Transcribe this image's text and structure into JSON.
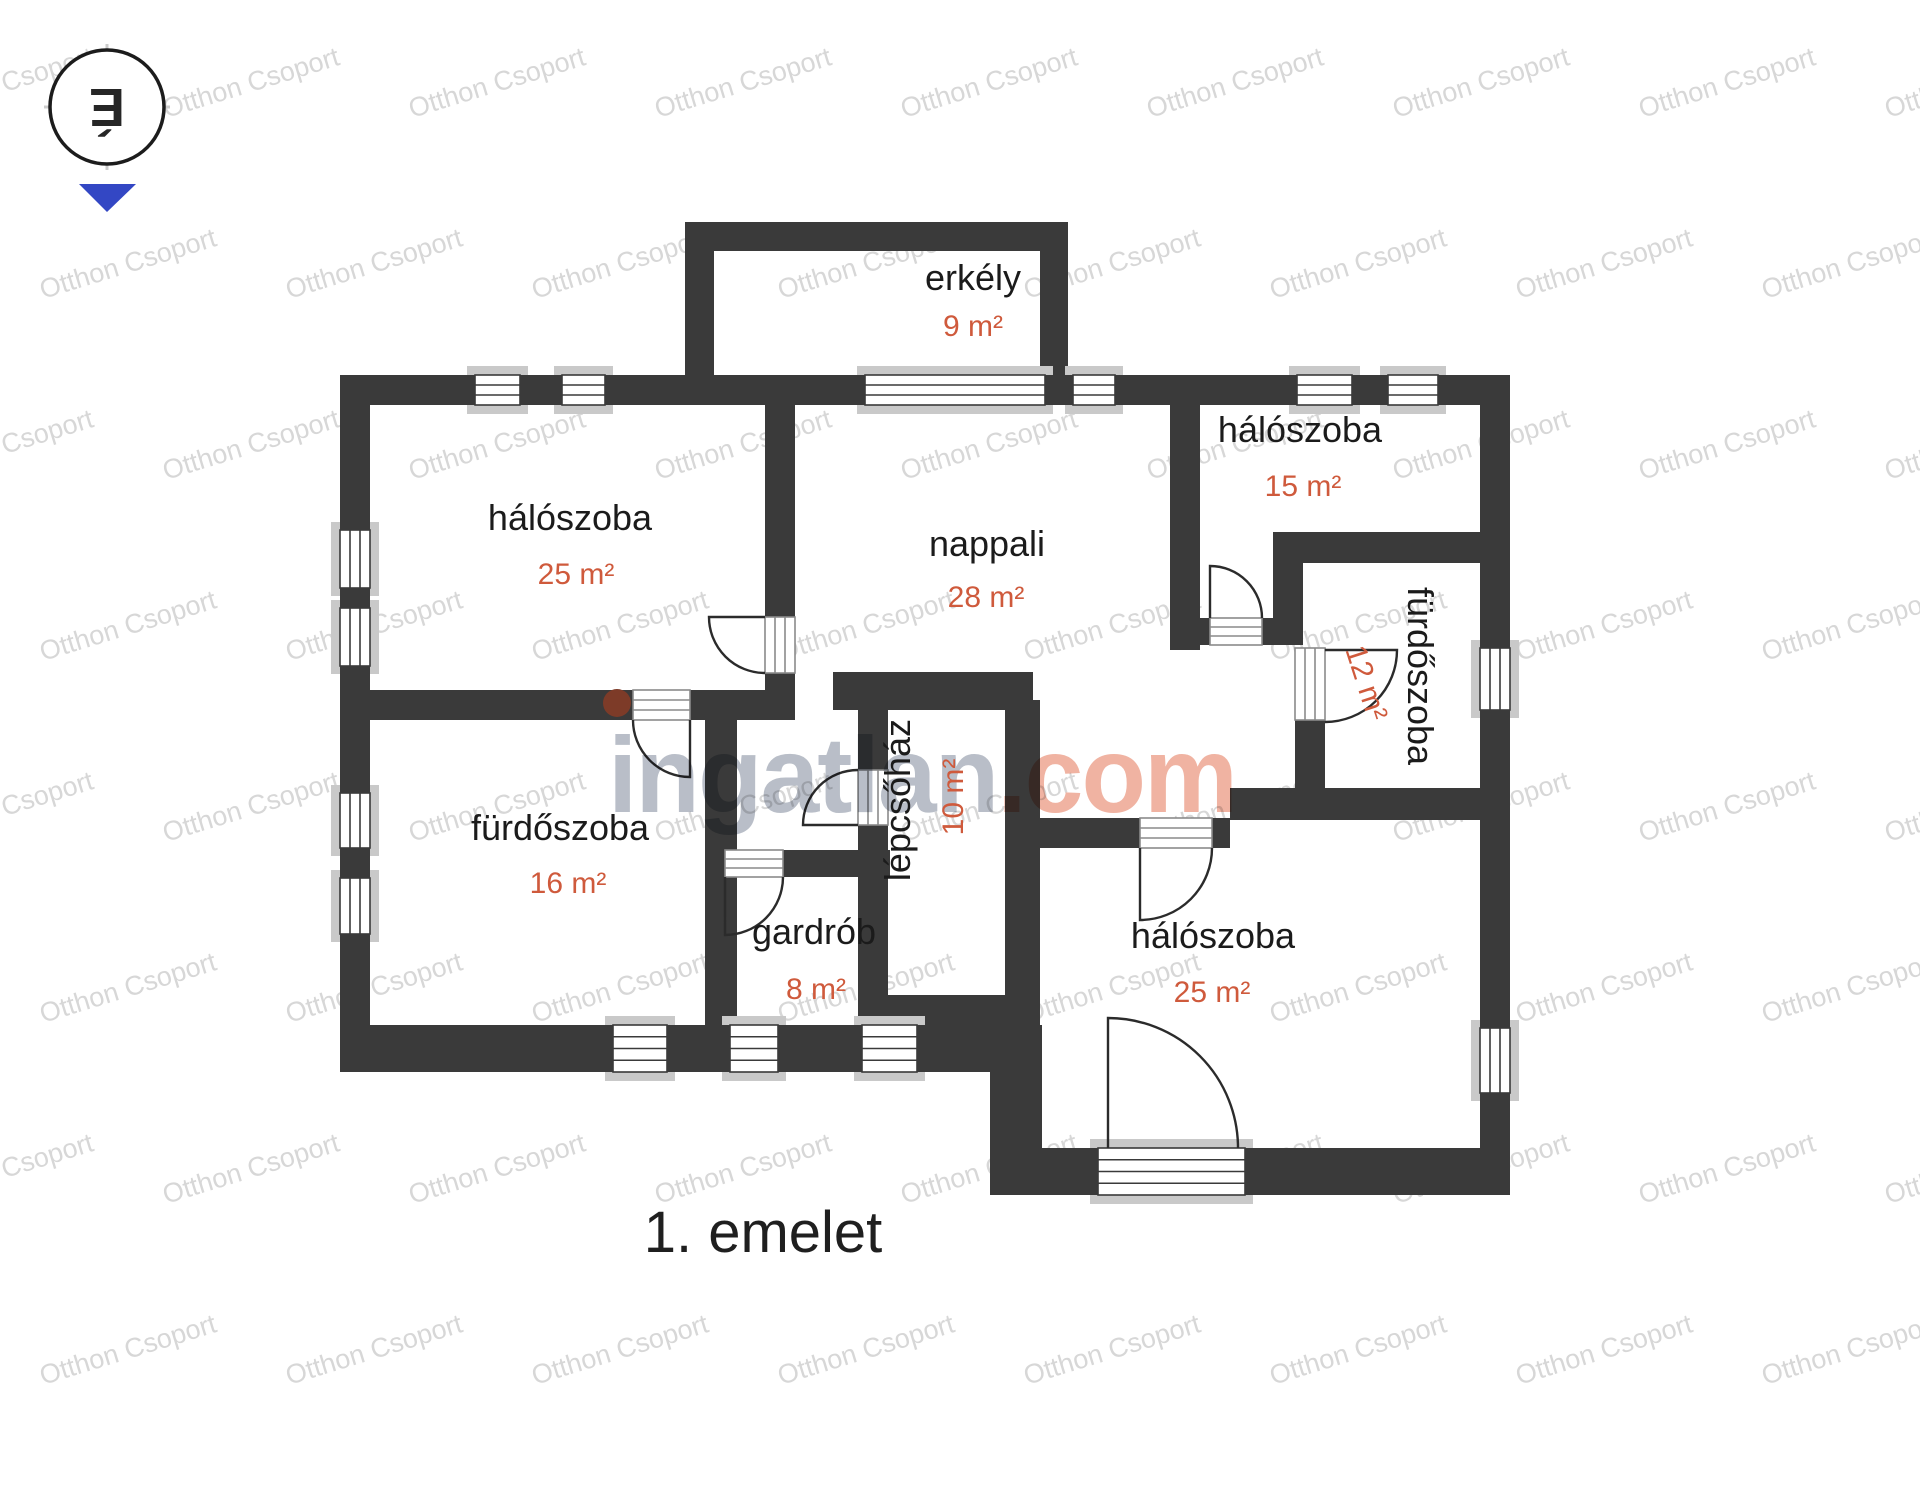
{
  "plan": {
    "floor_title": "1. emelet",
    "rooms": [
      {
        "name": "erkély",
        "area": "9 m²"
      },
      {
        "name": "hálószoba",
        "area": "25 m²"
      },
      {
        "name": "nappali",
        "area": "28 m²"
      },
      {
        "name": "hálószoba",
        "area": "15 m²"
      },
      {
        "name": "fürdőszoba",
        "area": "12 m²"
      },
      {
        "name": "fürdőszoba",
        "area": "16 m²"
      },
      {
        "name": "lépcsőház",
        "area": "10 m²"
      },
      {
        "name": "gardrób",
        "area": "8 m²"
      },
      {
        "name": "hálószoba",
        "area": "25 m²"
      }
    ]
  },
  "compass": {
    "north_letter": "É"
  },
  "watermark": {
    "tile_text": "Otthon Csoport",
    "brand_gray": "ingatlan",
    "brand_accent": ".com"
  },
  "colors": {
    "wall": "#3a3a3a",
    "sill": "#c9c9c9",
    "room-name": "#1b1b1b",
    "room-area": "#cf5a3c",
    "watermark-tile": "#d7d7d7",
    "brand-gray": "#b3b9c3",
    "brand-accent": "#efad9a",
    "door-line": "#2b2b2b",
    "compass-arrow": "#3347c4",
    "knob-dot": "#7d3b28"
  }
}
